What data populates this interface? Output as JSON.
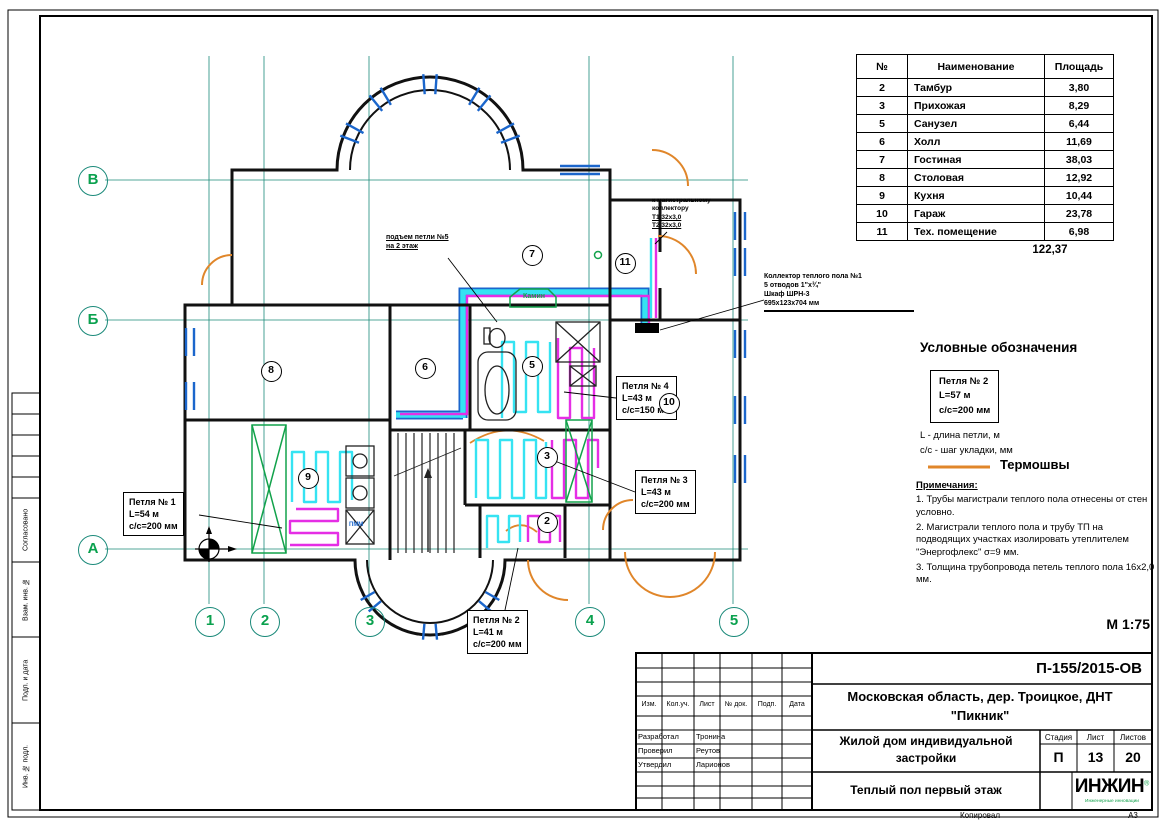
{
  "plan": {
    "grid_rows": [
      "В",
      "Б",
      "А"
    ],
    "grid_cols": [
      "1",
      "2",
      "3",
      "4",
      "5"
    ],
    "room_numbers": {
      "r7": "7",
      "r11": "11",
      "r8": "8",
      "r6": "6",
      "r5": "5",
      "r9": "9",
      "r3": "3",
      "r2": "2",
      "r10": "10"
    },
    "fireplace": "Камин",
    "dishwasher": "ПММ",
    "scale": "М 1:75",
    "loop1": {
      "name": "Петля № 1",
      "len": "L=54 м",
      "step": "с/с=200 мм"
    },
    "loop2": {
      "name": "Петля № 2",
      "len": "L=41 м",
      "step": "с/с=200 мм"
    },
    "loop3": {
      "name": "Петля № 3",
      "len": "L=43 м",
      "step": "с/с=200 мм"
    },
    "loop4": {
      "name": "Петля № 4",
      "len": "L=43 м",
      "step": "с/с=150 мм"
    },
    "riser_note": {
      "line1": "подъем петли №5",
      "line2": "на 2 этаж"
    },
    "main_note": {
      "line1": "к магистральному",
      "line2": "коллектору",
      "line3": "Т1 32х3,0",
      "line4": "Т2 32х3,0"
    },
    "collector_note": {
      "line1": "Коллектор теплого пола №1",
      "line2": "5 отводов 1\"х¾\"",
      "line3": "Шкаф ШРН-3",
      "line4": "695х123х704 мм"
    }
  },
  "rooms_table": {
    "headers": {
      "num": "№",
      "name": "Наименование",
      "area": "Площадь"
    },
    "rows": [
      {
        "num": "2",
        "name": "Тамбур",
        "area": "3,80"
      },
      {
        "num": "3",
        "name": "Прихожая",
        "area": "8,29"
      },
      {
        "num": "5",
        "name": "Санузел",
        "area": "6,44"
      },
      {
        "num": "6",
        "name": "Холл",
        "area": "11,69"
      },
      {
        "num": "7",
        "name": "Гостиная",
        "area": "38,03"
      },
      {
        "num": "8",
        "name": "Столовая",
        "area": "12,92"
      },
      {
        "num": "9",
        "name": "Кухня",
        "area": "10,44"
      },
      {
        "num": "10",
        "name": "Гараж",
        "area": "23,78"
      },
      {
        "num": "11",
        "name": "Тех. помещение",
        "area": "6,98"
      }
    ],
    "total": "122,37"
  },
  "legend": {
    "title": "Условные обозначения",
    "sample": {
      "name": "Петля № 2",
      "len": "L=57 м",
      "step": "с/с=200 мм"
    },
    "def1": "L - длина петли, м",
    "def2": "с/с - шаг укладки, мм",
    "thermo": "Термошвы",
    "notes_title": "Примечания:",
    "note1": "1. Трубы магистрали теплого пола отнесены от стен условно.",
    "note2": "2. Магистрали теплого пола и трубу ТП на подводящих участках изолировать утеплителем \"Энергофлекс\" σ=9 мм.",
    "note3": "3. Толщина трубопровода петель теплого пола 16х2,0 мм."
  },
  "title_block": {
    "doc_no": "П-155/2015-ОВ",
    "object_line": "Московская область, дер. Троицкое, ДНТ \"Пикник\"",
    "project": "Жилой дом индивидуальной застройки",
    "sheet_title": "Теплый пол первый этаж",
    "stage_label": "Стадия",
    "sheet_label": "Лист",
    "sheets_label": "Листов",
    "stage": "П",
    "sheet": "13",
    "sheets": "20",
    "col_izm": "Изм.",
    "col_kol": "Кол.уч.",
    "col_list": "Лист",
    "col_doc": "№ док.",
    "col_podp": "Подп.",
    "col_data": "Дата",
    "role1": "Разработал",
    "name1": "Тронина",
    "role2": "Проверил",
    "name2": "Реутов",
    "role3": "Утвердил",
    "name3": "Ларионов",
    "logo": "ИНЖИН",
    "logo_sub": "Инженерные инновации",
    "logo_reg": "®",
    "copied": "Копировал",
    "format": "А3"
  },
  "margin": {
    "l1": "Согласовано",
    "l2": "Взам. инв. №",
    "l3": "Подп. и дата",
    "l4": "Инв. № подл."
  }
}
